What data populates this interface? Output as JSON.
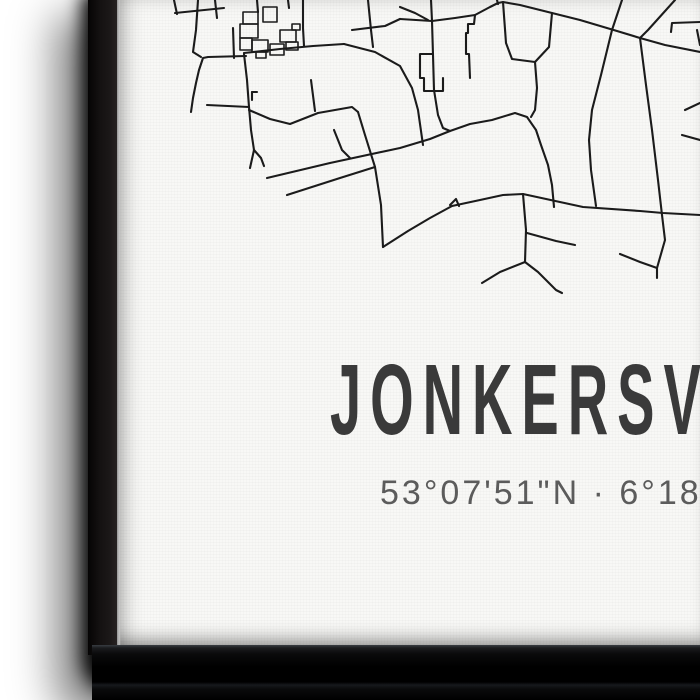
{
  "artwork": {
    "title": "JONKERSVAA",
    "coordinates": "53°07'51\"N · 6°18'58\"O",
    "colors": {
      "background": "#ffffff",
      "canvas_face": "#f8f8f6",
      "canvas_side": "#141111",
      "shadow": "#000000",
      "map_ink": "#1b1b1b",
      "title_color": "#3a3a3a",
      "coords_color": "#4f4f4f"
    },
    "map": {
      "road_stroke_width": 2.1,
      "building_stroke_width": 1.6,
      "roads": [
        "174,0 177,14",
        "175,13 224,8",
        "198,0 196,30 193,52 201,57",
        "215,0 217,18",
        "233,28 234,58",
        "257,0 258,12",
        "303,0 303,28 304,46",
        "288,0 289,8",
        "246,56 208,57 203,58 199,70 196,83 193,98 191,112",
        "244,54 247,80 249,107 251,130 254,150 250,168",
        "254,150 261,158 264,166",
        "249,107 207,105",
        "252,92 252,100",
        "252,92 257,92",
        "244,53 280,49 313,46 344,44",
        "344,44 375,52 400,66 412,88 418,110 423,145",
        "249,110 270,119 290,124 318,113 352,107 358,112",
        "311,80 315,111",
        "358,112 365,135 375,167 381,205 383,247",
        "383,247 408,231 430,218 452,206",
        "287,195 340,178 375,167",
        "267,178 330,163 400,148 430,139 450,131 470,124 492,120 515,113 527,117 536,130 541,145 548,165 552,185 554,207",
        "334,130 342,150 350,158",
        "431,0 432,21 433,55 434,90 438,115 443,128 450,131",
        "400,19 432,21 455,18 475,15 490,7 498,3 503,2 520,5 552,13 580,20 617,31 640,38 665,45 700,52",
        "400,7 415,13 428,20",
        "352,30 385,26 400,19",
        "368,0 371,30 373,47",
        "497,0 498,4",
        "475,15 474,24 468,24 468,33 466,33 466,54 469,54 470,78",
        "432,54 420,54 420,78 424,78 424,91 443,91 443,78",
        "503,2 506,43 512,59 535,62 549,47 552,13",
        "535,62 537,88 535,110 531,117",
        "452,206 480,200 503,195 523,194 583,207 640,211 663,213 700,215",
        "523,194 526,230 525,262",
        "525,262 500,272 482,283",
        "525,262 538,272 556,290 562,293",
        "527,233 556,241 575,245",
        "450,205 456,199 459,206",
        "622,0 612,30 601,75 592,110 589,140 591,170 596,206",
        "675,0 648,30 640,38 646,85 652,130 658,180 662,215 665,240 657,268 657,278",
        "620,254 640,262 657,268",
        "671,32 672,23 700,22",
        "697,30 700,45",
        "685,110 700,103",
        "682,135 700,140"
      ],
      "buildings": [
        "243,12 258,12 258,24 243,24 243,12",
        "263,7 277,7 277,22 263,22 263,7",
        "240,24 258,24 258,38 240,38 240,24",
        "240,38 252,38 252,50 240,50 240,38",
        "252,40 268,40 268,52 252,52 252,40",
        "256,52 266,52 266,58 256,58 256,52",
        "270,44 284,44 284,55 270,55 270,44",
        "280,30 296,30 296,42 280,42 280,30",
        "286,42 298,42 298,50 286,50 286,42",
        "292,24 300,24 300,30 292,30 292,24"
      ]
    }
  }
}
